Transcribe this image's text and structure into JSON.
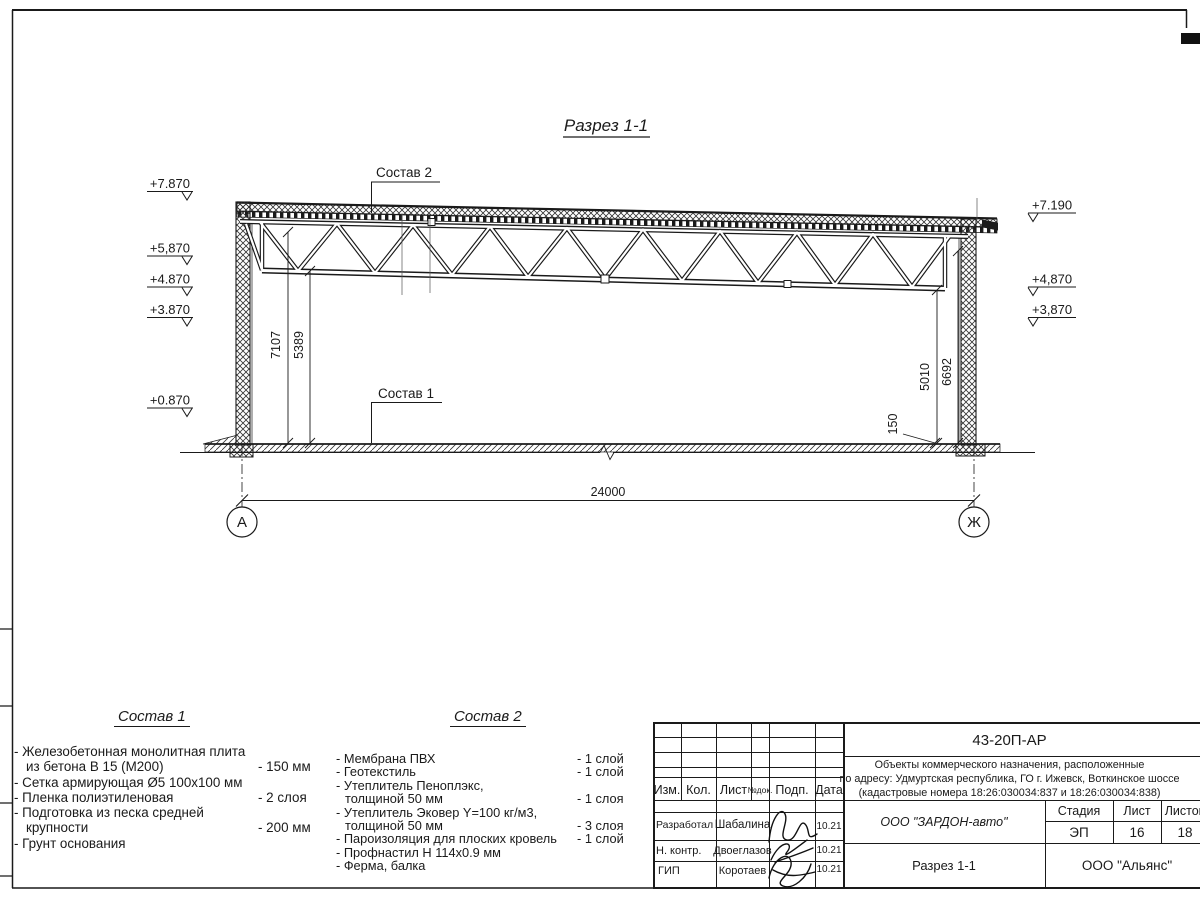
{
  "section": {
    "title": "Разрез 1-1"
  },
  "drawing": {
    "callout_top": "Состав 2",
    "callout_floor": "Состав 1",
    "elev_left": [
      "+7.870",
      "+5,870",
      "+4.870",
      "+3.870",
      "+0.870"
    ],
    "elev_right": [
      "+7.190",
      "+4,870",
      "+3,870"
    ],
    "dim_left_a": "7107",
    "dim_left_b": "5389",
    "dim_right_a": "5010",
    "dim_right_b": "6692",
    "dim_floor": "150",
    "dim_span": "24000",
    "axis_left": "А",
    "axis_right": "Ж"
  },
  "legend1": {
    "title": "Состав 1",
    "items": [
      {
        "t": "- Железобетонная  монолитная плита",
        "v": ""
      },
      {
        "t": "из бетона В 15 (М200)",
        "v": "- 150 мм"
      },
      {
        "t": "- Сетка армирующая Ø5 100х100 мм",
        "v": ""
      },
      {
        "t": "- Пленка полиэтиленовая",
        "v": "-  2 слоя"
      },
      {
        "t": "- Подготовка из песка средней",
        "v": ""
      },
      {
        "t": "крупности",
        "v": "- 200 мм"
      },
      {
        "t": "- Грунт основания",
        "v": ""
      }
    ]
  },
  "legend2": {
    "title": "Состав 2",
    "items": [
      {
        "t": "- Мембрана ПВХ",
        "v": "- 1 слой"
      },
      {
        "t": "- Геотекстиль",
        "v": "- 1 слой"
      },
      {
        "t": "- Утеплитель Пеноплэкс,",
        "v": ""
      },
      {
        "t": "толщиной 50 мм",
        "v": "- 1 слоя"
      },
      {
        "t": "- Утеплитель Эковер Y=100 кг/м3,",
        "v": ""
      },
      {
        "t": "толщиной 50 мм",
        "v": "- 3 слоя"
      },
      {
        "t": "- Пароизоляция для плоских кровель",
        "v": "- 1 слой"
      },
      {
        "t": "- Профнастил Н 114х0.9 мм",
        "v": ""
      },
      {
        "t": "- Ферма, балка",
        "v": ""
      }
    ]
  },
  "titleblock": {
    "doc_number": "43-20П-АР",
    "project_line1": "Объекты коммерческого назначения, расположенные",
    "project_line2": "по адресу: Удмуртская республика, ГО г. Ижевск, Воткинское шоссе",
    "project_line3": "(кадастровые номера 18:26:030034:837 и 18:26:030034:838)",
    "col_izm": "Изм.",
    "col_kol": "Кол.",
    "col_list": "Лист",
    "col_ndoc": "№док.",
    "col_podp": "Подп.",
    "col_data": "Дата",
    "row1_role": "Разработал",
    "row1_name": "Шабалина",
    "row1_date": "10.21",
    "row2_role": "Н. контр.",
    "row2_name": "Двоеглазов",
    "row2_date": "10.21",
    "row3_role": "ГИП",
    "row3_name": "Коротаев",
    "row3_date": "10.21",
    "company": "ООО \"ЗАРДОН-авто\"",
    "stage_label": "Стадия",
    "sheet_label": "Лист",
    "sheets_label": "Листов",
    "stage": "ЭП",
    "sheet_no": "16",
    "sheets_total": "18",
    "drawing_name": "Разрез 1-1",
    "org": "ООО \"Альянс\""
  }
}
